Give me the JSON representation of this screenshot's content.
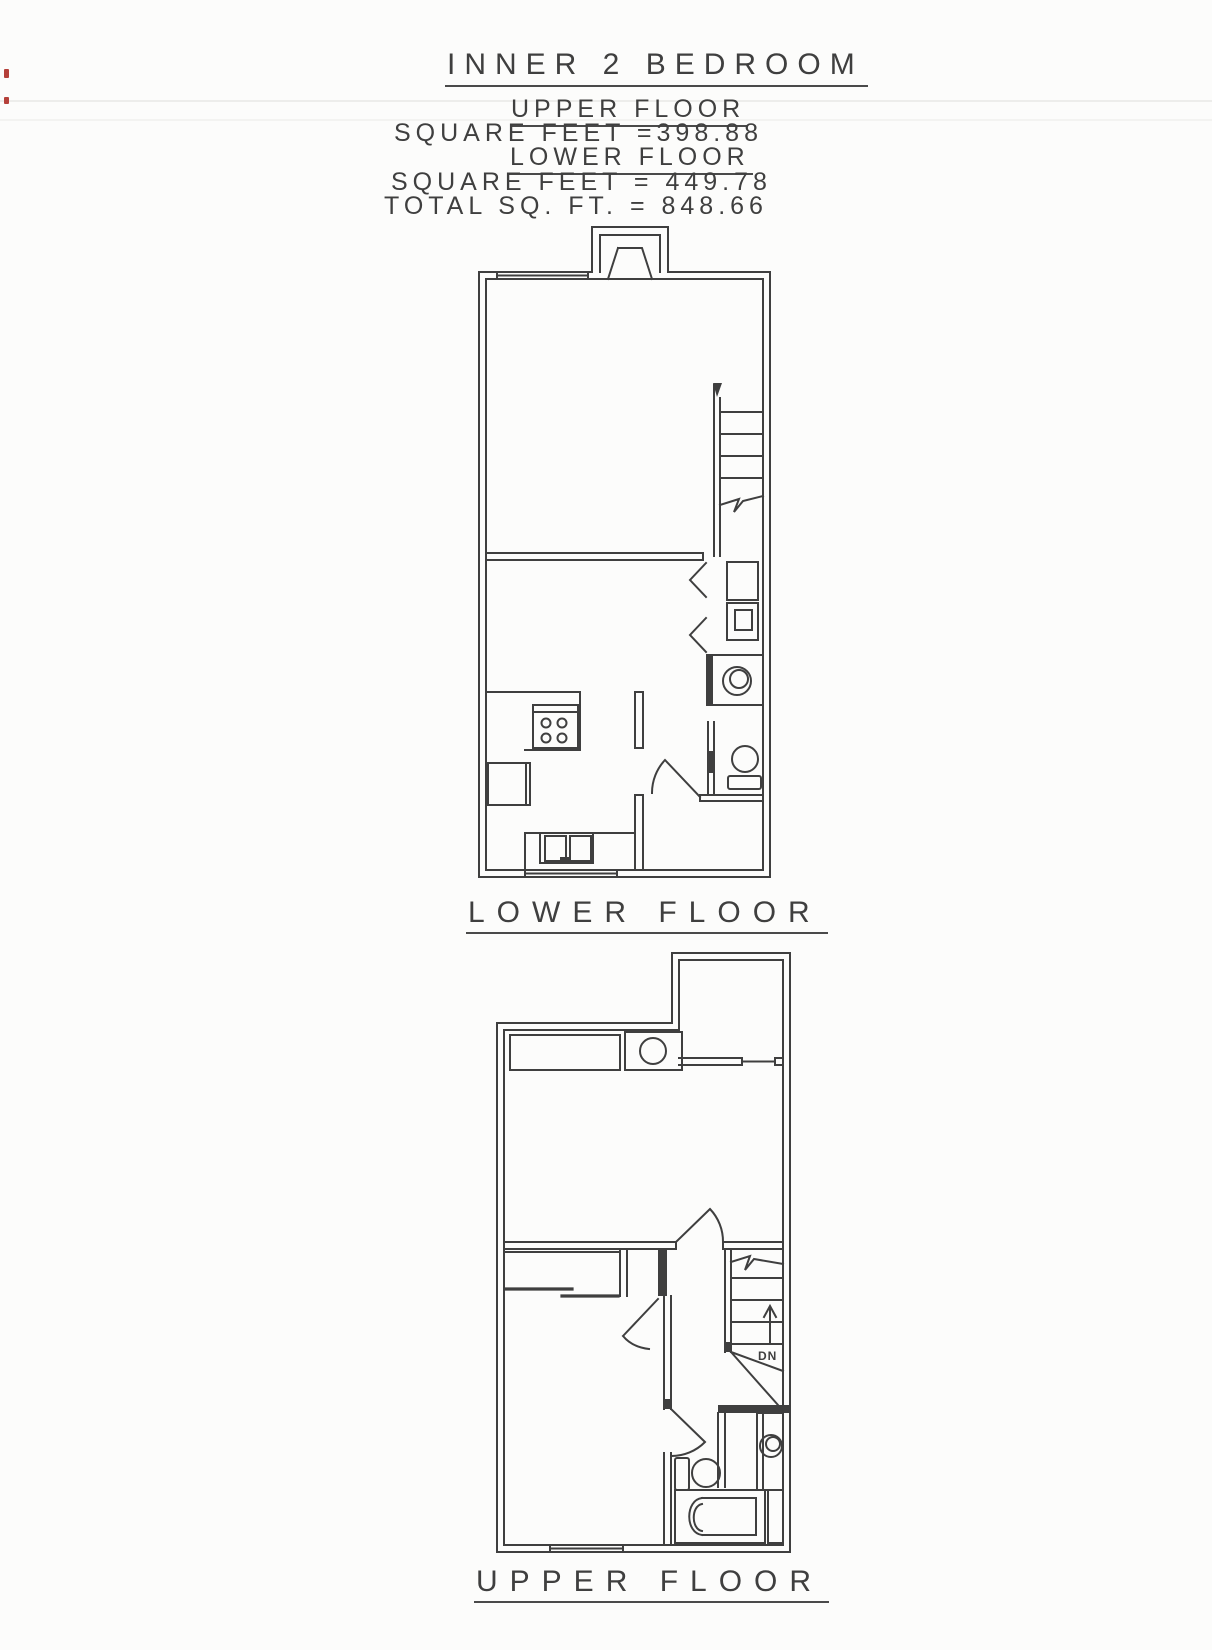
{
  "document": {
    "title": "INNER 2 BEDROOM",
    "summary": [
      {
        "label": "UPPER FLOOR"
      },
      {
        "label": "SQUARE FEET =398.88"
      },
      {
        "label": "LOWER FLOOR"
      },
      {
        "label": "SQUARE FEET = 449.78"
      },
      {
        "label": "TOTAL SQ. FT. = 848.66"
      }
    ],
    "areas": {
      "upper_floor_sqft": "398.88",
      "lower_floor_sqft": "449.78",
      "total_sqft": "848.66"
    },
    "plans": [
      {
        "caption": "LOWER FLOOR",
        "features": [
          "fireplace",
          "window",
          "staircase-up-with-break-line",
          "bifold-closet",
          "washer-dryer",
          "water-heater",
          "half-bath-toilet",
          "kitchen-range",
          "refrigerator",
          "double-sink"
        ]
      },
      {
        "caption": "UPPER FLOOR",
        "stair_direction_label": "DN",
        "features": [
          "deck",
          "closet",
          "laundry-fixture",
          "bedroom-doors",
          "sliding-closet-doors",
          "staircase-down",
          "toilet",
          "vanity-sink",
          "bathtub",
          "window"
        ]
      }
    ],
    "ink_color": "#3f3f3f",
    "paper_color": "#fcfcfb"
  }
}
